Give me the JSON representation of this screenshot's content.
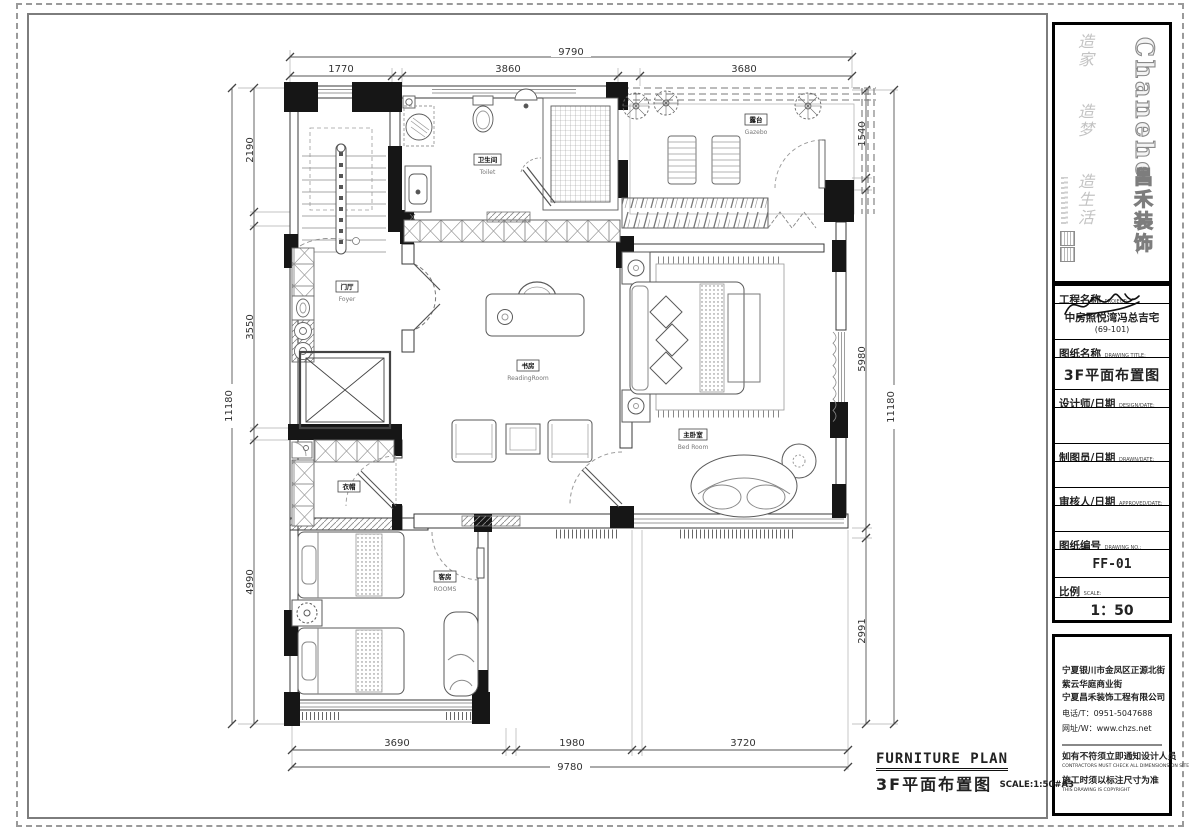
{
  "footer": {
    "title_en": "FURNITURE PLAN",
    "title_zh": "3F平面布置图",
    "scale_note": "SCALE:1:50#A3"
  },
  "logo": {
    "brand": "Chanehe",
    "company": "昌禾装饰",
    "slogans": [
      "造家",
      "造梦",
      "造生活"
    ]
  },
  "titleblock": {
    "project_label": "工程名称",
    "project_label_en": "PROJECT:",
    "project_value": "中房照悦湾冯总吉宅",
    "project_sub": "(69-101)",
    "drawing_label": "图纸名称",
    "drawing_label_en": "DRAWING TITLE:",
    "drawing_value": "3F平面布置图",
    "designer_label": "设计师/日期",
    "designer_label_en": "DESIGN/DATE:",
    "drafter_label": "制图员/日期",
    "drafter_label_en": "DRAWN/DATE:",
    "checker_label": "审核人/日期",
    "checker_label_en": "APPROVED/DATE:",
    "no_label": "图纸编号",
    "no_label_en": "DRAWING NO.:",
    "no_value": "FF-01",
    "scale_label": "比例",
    "scale_label_en": "SCALE:",
    "scale_value": "1：50"
  },
  "company_info": {
    "address1": "宁夏银川市金凤区正源北街",
    "address2": "紫云华庭商业街",
    "company": "宁夏昌禾装饰工程有限公司",
    "phone": "电话/T：0951-5047688",
    "web": "网址/W：www.chzs.net",
    "note1": "如有不符须立即通知设计人员",
    "note1_en": "CONTRACTORS MUST CHECK ALL DIMENSIONS ON SITE",
    "note2": "施工时须以标注尺寸为准",
    "note2_en": "THIS DRAWING IS COPYRIGHT"
  },
  "dimensions": {
    "top": {
      "overall": "9790",
      "seg1": "1770",
      "seg2": "3860",
      "seg3": "3680"
    },
    "bottom": {
      "overall": "9780",
      "seg1": "3690",
      "seg2": "1980",
      "seg3": "3720"
    },
    "left": {
      "overall": "11180",
      "seg1": "2190",
      "seg2": "3550",
      "seg3": "4990"
    },
    "right": {
      "overall": "11180",
      "seg1": "1540",
      "seg2": "5980",
      "seg3": "2991"
    }
  },
  "rooms": {
    "toilet": {
      "zh": "卫生间",
      "en": "Toilet"
    },
    "gazebo": {
      "zh": "露台",
      "en": "Gazebo"
    },
    "foyer": {
      "zh": "门厅",
      "en": "Foyer"
    },
    "reading": {
      "zh": "书房",
      "en": "ReadingRoom"
    },
    "bedroom": {
      "zh": "主卧室",
      "en": "Bed Room"
    },
    "cloak": {
      "zh": "衣帽",
      "en": ""
    },
    "guest": {
      "zh": "客房",
      "en": "ROOMS"
    }
  }
}
